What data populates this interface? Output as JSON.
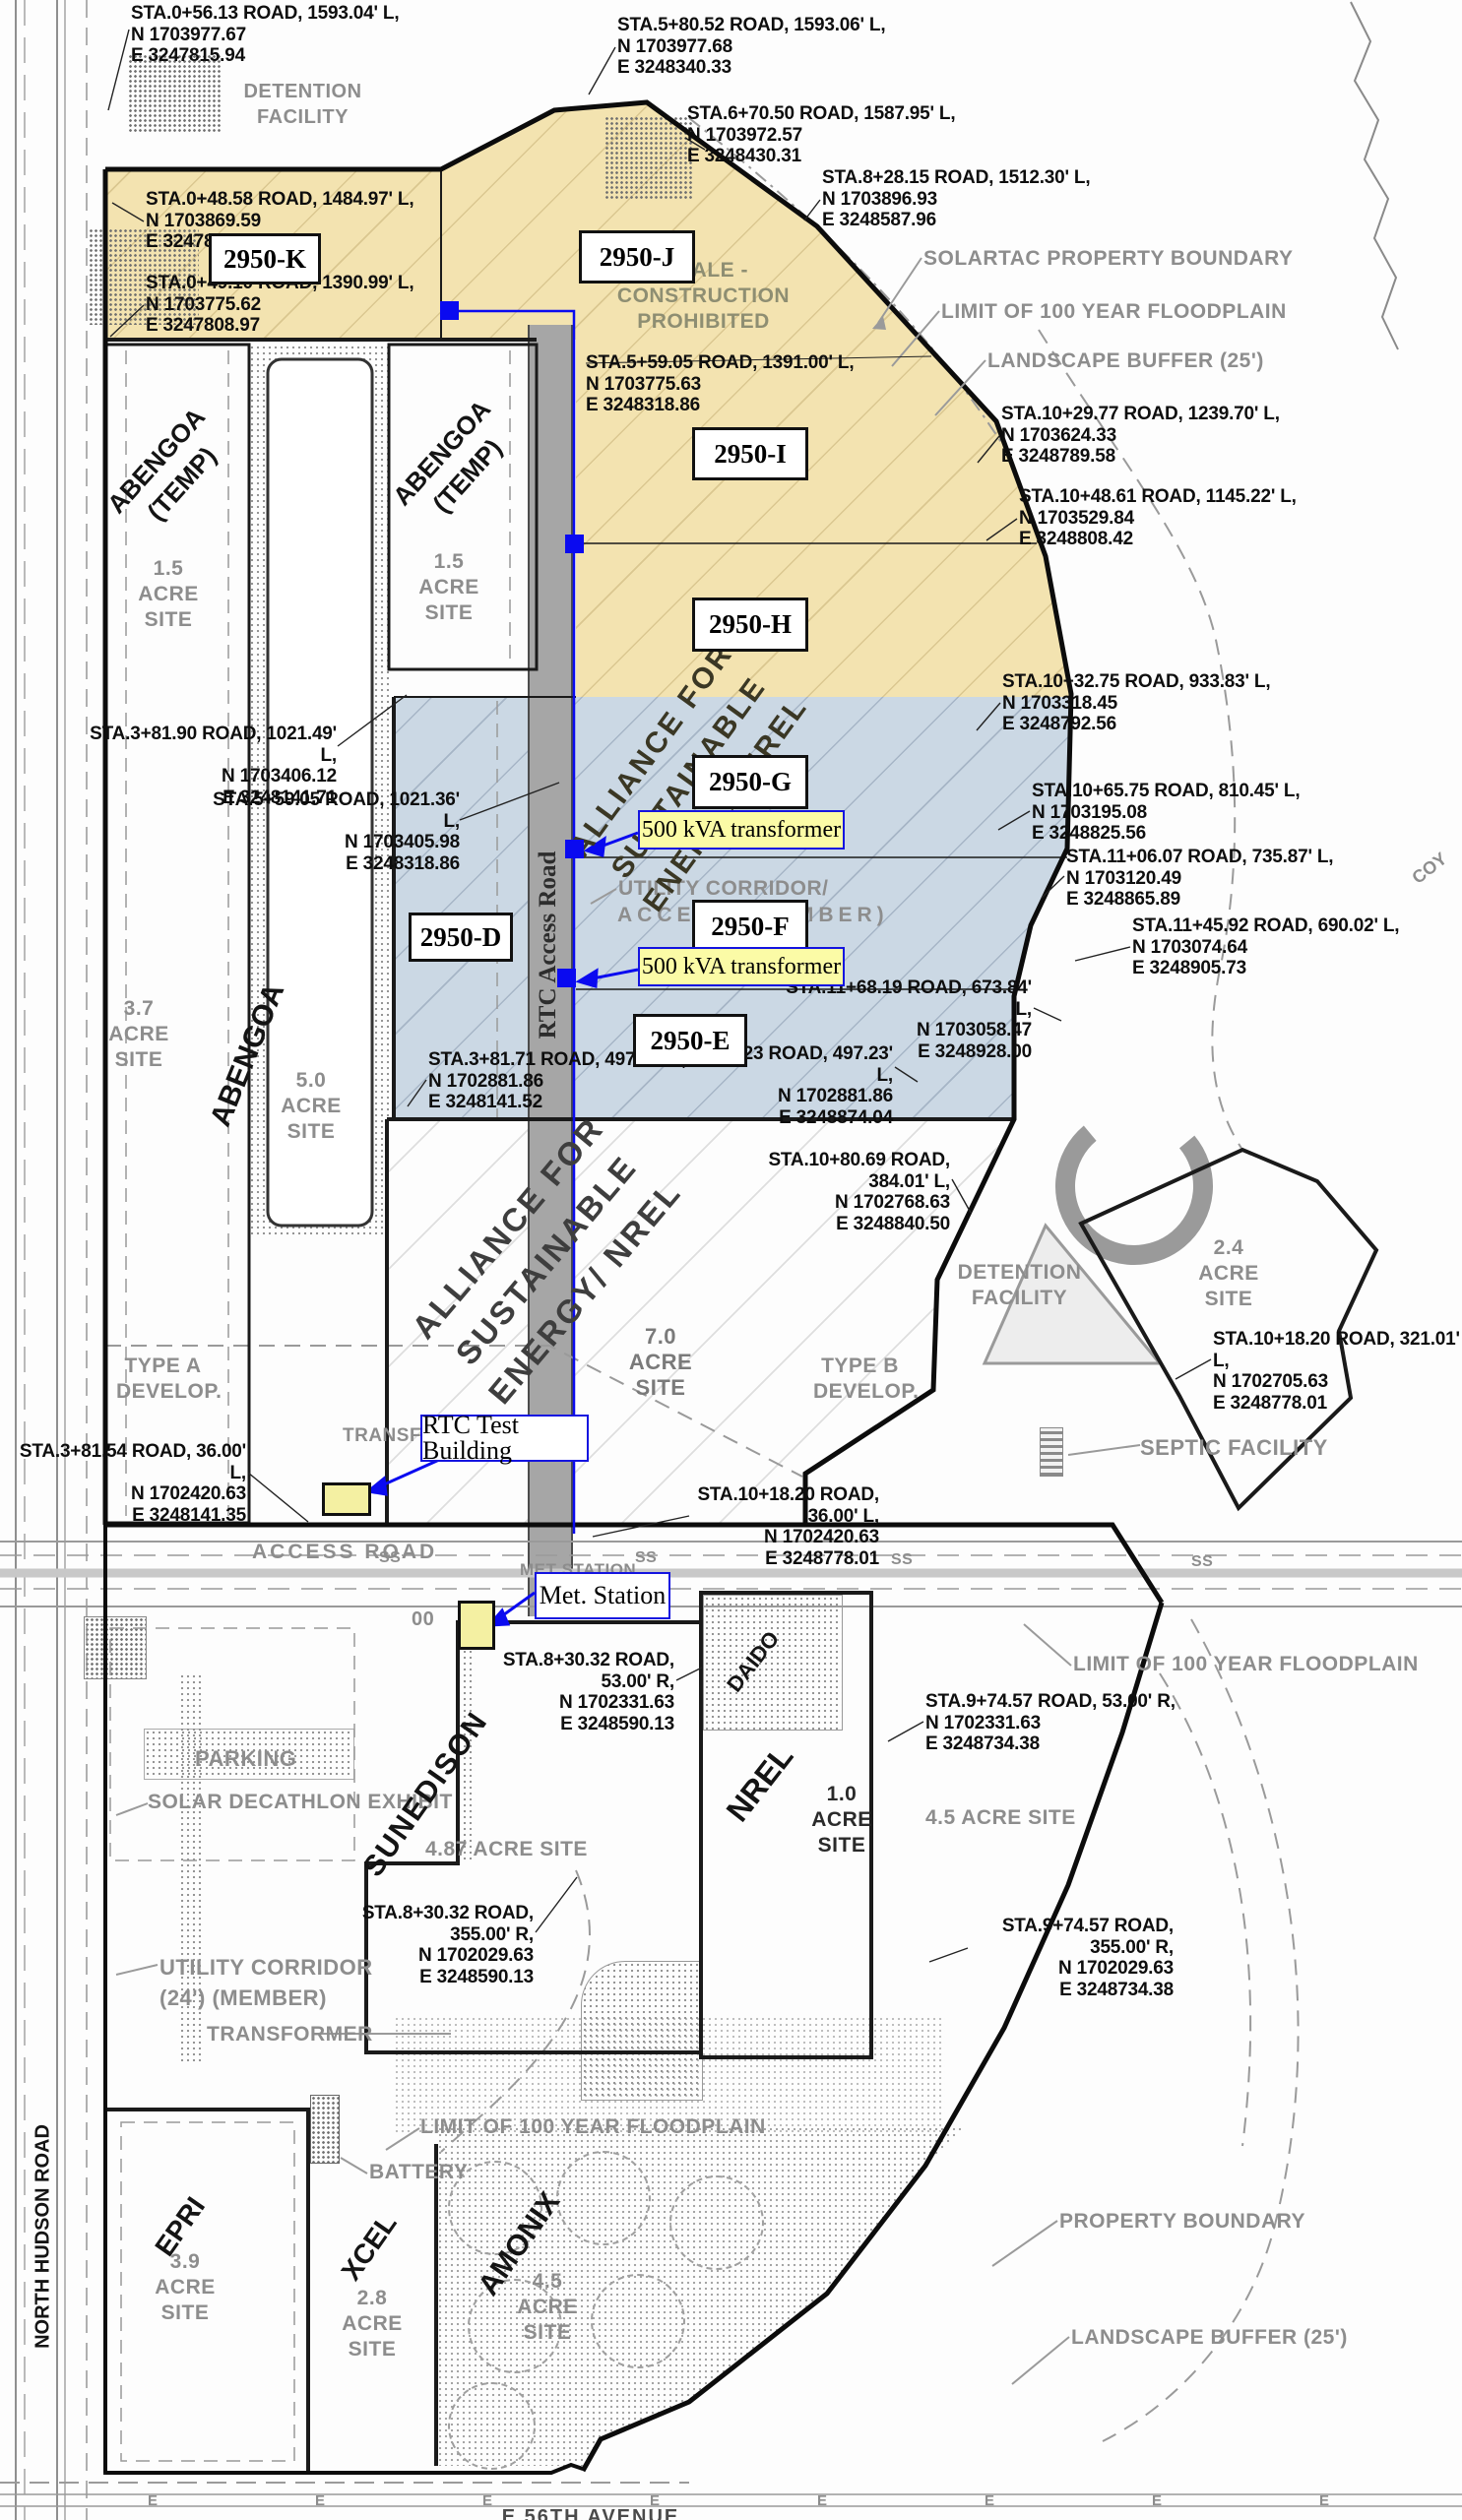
{
  "colors": {
    "parcel_yellow": "#F3E3B0",
    "parcel_blue": "#CBD8E4",
    "callout_yellow": "#FBFBA6",
    "annotation_blue": "#0A0AF0",
    "label_gray": "#8D8D8D"
  },
  "parcel_boxes": {
    "k": "2950-K",
    "j": "2950-J",
    "i": "2950-I",
    "h": "2950-H",
    "g": "2950-G",
    "f": "2950-F",
    "e": "2950-E",
    "d": "2950-D"
  },
  "callouts": {
    "transformer_g": "500 kVA transformer",
    "transformer_f": "500 kVA transformer",
    "rtc_test_building": "RTC Test Building",
    "met_station": "Met. Station"
  },
  "tenants": {
    "abengoa_temp_1": "ABENGOA\n(TEMP)",
    "abengoa_temp_2": "ABENGOA\n(TEMP)",
    "abengoa": "ABENGOA",
    "alliance_upper": "ALLIANCE FOR\nSUSTAINABLE\nENERGY/ NREL",
    "alliance_lower": "ALLIANCE FOR\nSUSTAINABLE\nENERGY/ NREL",
    "sunedison": "SUNEDISON",
    "nrel": "NREL",
    "daido": "DAIDO",
    "epri": "EPRI",
    "xcel": "XCEL",
    "amonix": "AMONIX"
  },
  "areas": {
    "acre_15_a": "1.5\nACRE\nSITE",
    "acre_15_b": "1.5\nACRE\nSITE",
    "acre_37": "3.7\nACRE\nSITE",
    "acre_50": "5.0\nACRE\nSITE",
    "acre_70": "7.0\nACRE\nSITE",
    "acre_24": "2.4\nACRE\nSITE",
    "acre_10": "1.0\nACRE\nSITE",
    "acre_487": "4.87 ACRE SITE",
    "acre_45_east": "4.5 ACRE SITE",
    "acre_39": "3.9\nACRE\nSITE",
    "acre_28": "2.8\nACRE\nSITE",
    "acre_45_amonix": "4.5\nACRE\nSITE",
    "type_a": "TYPE A\nDEVELOP.",
    "type_b": "TYPE B\nDEVELOP."
  },
  "labels": {
    "detention_top": "DETENTION\nFACILITY",
    "detention_mid": "DETENTION\nFACILITY",
    "solartac_boundary": "SOLARTAC PROPERTY BOUNDARY",
    "floodplain_top": "LIMIT OF 100 YEAR FLOODPLAIN",
    "landscape_top": "LANDSCAPE BUFFER (25')",
    "swale": "SWALE -\nCONSTRUCTION\nPROHIBITED",
    "utility_corridor_1": "UTILITY CORRIDOR/",
    "utility_corridor_2": "ACCESS (MEMBER)",
    "utility_corridor_lower": "UTILITY CORRIDOR\n(24') (MEMBER)",
    "transformer_rtc": "TRANSFORMER",
    "transformer_lower": "TRANSFORMER",
    "access_road": "ACCESS ROAD",
    "met_station_under": "MET STATION",
    "parking": "PARKING",
    "solar_decathlon": "SOLAR DECATHLON EXHIBIT",
    "battery": "BATTERY",
    "floodplain_east": "LIMIT OF 100 YEAR FLOODPLAIN",
    "floodplain_bottom": "LIMIT OF 100 YEAR FLOODPLAIN",
    "property_boundary": "PROPERTY BOUNDARY",
    "landscape_bottom": "LANDSCAPE BUFFER (25')",
    "septic": "SEPTIC FACILITY",
    "north_hudson_road": "NORTH HUDSON ROAD",
    "rtc_access_road": "RTC Access Road",
    "e56_avenue": "E 56TH AVENUE",
    "coy": "COY",
    "zeros": "00",
    "ss_mark": "SS",
    "e_mark": "E"
  },
  "sta": {
    "s01": "STA.0+56.13 ROAD, 1593.04' L,\nN 1703977.67\nE 3247815.94",
    "s02": "STA.5+80.52 ROAD, 1593.06' L,\nN 1703977.68\nE 3248340.33",
    "s03": "STA.6+70.50 ROAD, 1587.95' L,\nN 1703972.57\nE 3248430.31",
    "s04": "STA.8+28.15 ROAD, 1512.30' L,\nN 1703896.93\nE 3248587.96",
    "s05": "STA.0+48.58 ROAD, 1484.97' L,\nN 1703869.59\nE 32478",
    "s06": "STA.0+49.10 ROAD, 1390.99' L,\nN 1703775.62\nE 3247808.97",
    "s07": "STA.5+59.05 ROAD, 1391.00' L,\nN 1703775.63\nE 3248318.86",
    "s08": "STA.10+29.77 ROAD, 1239.70' L,\nN 1703624.33\nE 3248789.58",
    "s09": "STA.10+48.61 ROAD, 1145.22' L,\nN 1703529.84\nE 3248808.42",
    "s10": "STA.3+81.90 ROAD, 1021.49' L,\nN 1703406.12\nE 3248141.71",
    "s11": "STA.5+59.05 ROAD, 1021.36' L,\nN 1703405.98\nE 3248318.86",
    "s12": "STA.10+32.75 ROAD, 933.83' L,\nN 1703318.45\nE 3248792.56",
    "s13": "STA.10+65.75 ROAD, 810.45' L,\nN 1703195.08\nE 3248825.56",
    "s14": "STA.11+06.07 ROAD, 735.87' L,\nN 1703120.49\nE 3248865.89",
    "s15": "STA.11+45.92 ROAD, 690.02' L,\nN 1703074.64\nE 3248905.73",
    "s16": "STA.11+68.19 ROAD, 673.84' L,\nN 1703058.47\nE 3248928.00",
    "s17": "STA.3+81.71 ROAD, 497.23' L,\nN 1702881.86\nE 3248141.52",
    "s18": "STA.11+14.23 ROAD, 497.23' L,\nN 1702881.86\nE 3248874.04",
    "s19": "STA.10+80.69 ROAD, 384.01' L,\nN 1702768.63\nE 3248840.50",
    "s20": "STA.10+18.20 ROAD, 321.01' L,\nN 1702705.63\nE 3248778.01",
    "s21": "STA.3+81.54 ROAD, 36.00' L,\nN 1702420.63\nE 3248141.35",
    "s22": "STA.10+18.20 ROAD, 36.00' L,\nN 1702420.63\nE 3248778.01",
    "s23": "STA.8+30.32 ROAD, 53.00' R,\nN 1702331.63\nE 3248590.13",
    "s24": "STA.9+74.57 ROAD, 53.00' R,\nN 1702331.63\nE 3248734.38",
    "s25": "STA.8+30.32 ROAD, 355.00' R,\nN 1702029.63\nE 3248590.13",
    "s26": "STA.9+74.57 ROAD, 355.00' R,\nN 1702029.63\nE 3248734.38"
  }
}
